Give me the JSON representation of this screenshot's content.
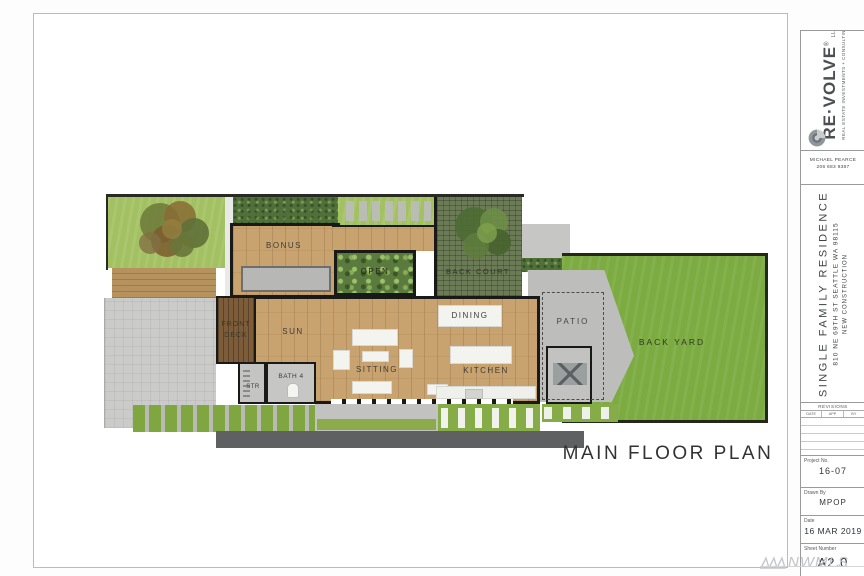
{
  "sheet": {
    "plan_title": "MAIN FLOOR PLAN",
    "watermark": "NWMLS"
  },
  "title_block": {
    "brand": {
      "name": "RE·VOLVE",
      "registered": "®",
      "suffix": "LLC",
      "tagline": "REAL ESTATE INVESTMENTS + CONSULTING",
      "contact_name": "MICHAEL PEARCE",
      "contact_phone": "206 683 9387"
    },
    "project": {
      "name": "SINGLE FAMILY RESIDENCE",
      "address": "810 NE 69TH ST SEATTLE WA 98115",
      "subtitle": "NEW CONSTRUCTION"
    },
    "revisions": {
      "title": "REVISIONS",
      "columns": [
        "DATE",
        "APP",
        "BY"
      ]
    },
    "fields": {
      "project_no": {
        "label": "Project No.",
        "value": "16-07"
      },
      "drawn_by": {
        "label": "Drawn By",
        "value": "MPOP"
      },
      "date": {
        "label": "Date",
        "value": "16 MAR 2019"
      },
      "sheet_number": {
        "label": "Sheet Number",
        "value": "A2.0"
      }
    }
  },
  "floor_plan": {
    "labels": {
      "bonus": "BONUS",
      "open": "OPEN",
      "back_court": "BACK COURT",
      "front_deck": "FRONT DECK",
      "sun": "SUN",
      "str": "STR",
      "bath4": "BATH 4",
      "sitting": "SITTING",
      "dining": "DINING",
      "kitchen": "KITCHEN",
      "patio": "PATIO",
      "back_yard": "BACK YARD"
    }
  }
}
